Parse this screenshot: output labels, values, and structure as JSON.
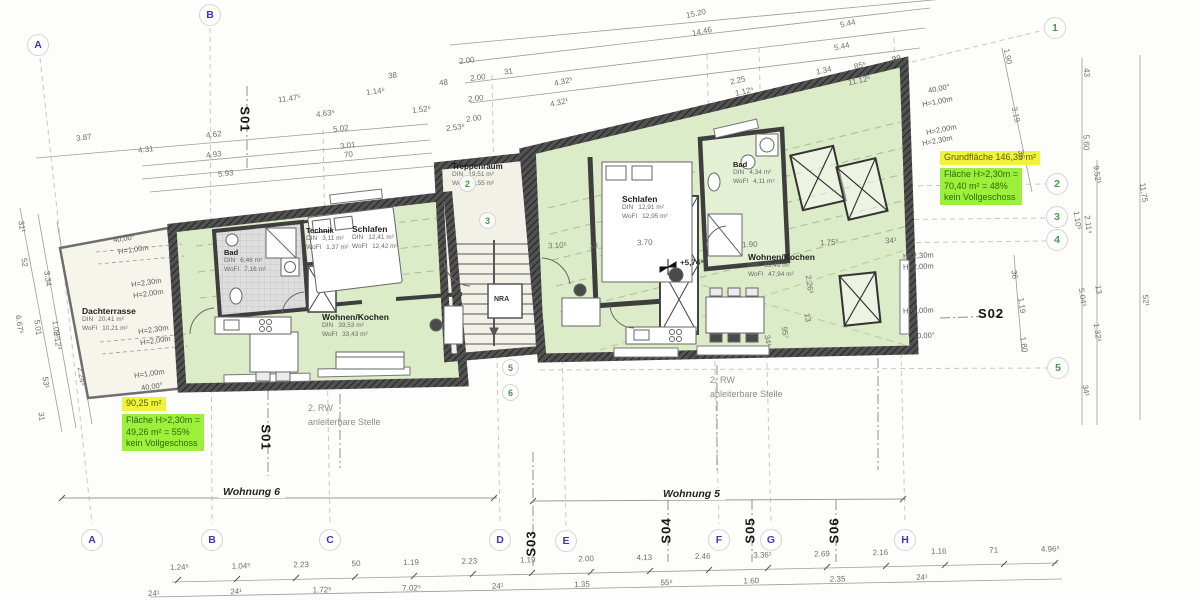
{
  "grid_markers": {
    "top": [
      "A",
      "B"
    ],
    "bottom": [
      "A",
      "B",
      "C",
      "D",
      "E",
      "F",
      "G",
      "H"
    ],
    "right": [
      "1",
      "2",
      "3",
      "4",
      "5"
    ],
    "inner": [
      "2",
      "3",
      "5",
      "6"
    ]
  },
  "sections": {
    "s01_top": "S01",
    "s01_bottom": "S01",
    "s02": "S02",
    "s03": "S03",
    "s04": "S04",
    "s05": "S05",
    "s06": "S06"
  },
  "apartments": {
    "wohnung6_label": "Wohnung 6",
    "wohnung5_label": "Wohnung 5"
  },
  "labels": {
    "din": "DIN",
    "wofl": "WoFl",
    "rw_line1": "2. RW",
    "rw_line2": "anleiterbare Stelle",
    "nra": "NRA",
    "level": "+5,74⁵"
  },
  "rooms": {
    "w6_dachterrasse": {
      "name": "Dachterrasse",
      "din": "20,41 m²",
      "wofl": "10,21 m²"
    },
    "w6_bad": {
      "name": "Bad",
      "din": "6,46 m²",
      "wofl": "7,16 m²"
    },
    "w6_technik": {
      "name": "Technik",
      "din": "3,11 m²",
      "wofl": "1,37 m²"
    },
    "w6_schlafen": {
      "name": "Schlafen",
      "din": "12,41 m²",
      "wofl": "12,42 m²"
    },
    "w6_wohnen": {
      "name": "Wohnen/Kochen",
      "din": "39,53 m²",
      "wofl": "33,43 m²"
    },
    "treppenraum": {
      "name": "Treppenraum",
      "din": "19,51 m²",
      "wofl": "4,55 m²"
    },
    "w5_schlafen": {
      "name": "Schlafen",
      "din": "12,91 m²",
      "wofl": "12,95 m²"
    },
    "w5_bad": {
      "name": "Bad",
      "din": "4,34 m²",
      "wofl": "4,11 m²"
    },
    "w5_wohnen": {
      "name": "Wohnen/Kochen",
      "din": "59,49 m²",
      "wofl": "47,94 m²"
    }
  },
  "highlights": {
    "left": {
      "area": "90,25 m²",
      "line1": "Fläche H>2,30m =",
      "line2": "49,26 m² = 55%",
      "line3": "kein Vollgeschoss"
    },
    "right": {
      "area": "Grundfläche 146,35 m²",
      "line1": "Fläche H>2,30m =",
      "line2": "70,40 m² = 48%",
      "line3": "kein Vollgeschoss"
    }
  },
  "annotations": {
    "h100": "H=1,00m",
    "h200": "H=2,00m",
    "h230": "H=2,30m",
    "angle": "40,00°"
  },
  "dims": {
    "top_left": [
      "3.87",
      "4.31",
      "4.62",
      "4.93",
      "5.93",
      "11.47⁵",
      "4.63⁵",
      "5.02",
      "3.01",
      "70",
      "38",
      "1.14⁵",
      "48",
      "1.52⁵",
      "2.53⁵",
      "2.00",
      "2.00",
      "2.00",
      "2.00",
      "31"
    ],
    "top_right": [
      "15.20",
      "14.46",
      "5.44",
      "5.44",
      "4.32⁵",
      "4.32¹",
      "2.25",
      "1.12⁵",
      "1.34",
      "85⁵",
      "99",
      "11.12⁵"
    ],
    "right_edge": [
      "1.90",
      "3.19",
      "36",
      "43",
      "5.60",
      "9.52¹",
      "11.75",
      "1.10⁵",
      "2.11⁴",
      "5.04⁵",
      "13",
      "1.32⁵",
      "34¹",
      "52¹",
      "36",
      "1.19",
      "1.80"
    ],
    "left_edge": [
      "31¹",
      "52",
      "3.34",
      "6.67⁵",
      "5.01",
      "1.09¹",
      "2.12⁴",
      "2.24⁵",
      "53¹",
      "31"
    ],
    "interior": [
      "3.10⁵",
      "13",
      "3.70",
      "1.90",
      "1.75⁵",
      "34¹",
      "2.26⁵",
      "13",
      "95⁷",
      "34¹"
    ],
    "bottom_row1": [
      "1.24⁵",
      "1.04⁵",
      "2.23",
      "50",
      "1.19",
      "2.23",
      "1.19",
      "2.00",
      "4.13",
      "2.46",
      "3.36¹",
      "2.69",
      "2.16",
      "1.16",
      "71",
      "4.96⁵"
    ],
    "bottom_row2": [
      "24¹",
      "24¹",
      "1.72⁵",
      "7.02⁵",
      "24¹",
      "1.35",
      "55⁵",
      "1.60",
      "2.35",
      "24¹"
    ]
  },
  "colors": {
    "room_fill": "#dcebc8",
    "terrace_fill": "#f6f5ec",
    "wall": "#4d4d4d",
    "highlight_yellow": "#f0f23c",
    "highlight_green": "#9cef3a",
    "grid_letter_blue": "#3a3aad",
    "grid_number_green": "#4a9a4a"
  }
}
